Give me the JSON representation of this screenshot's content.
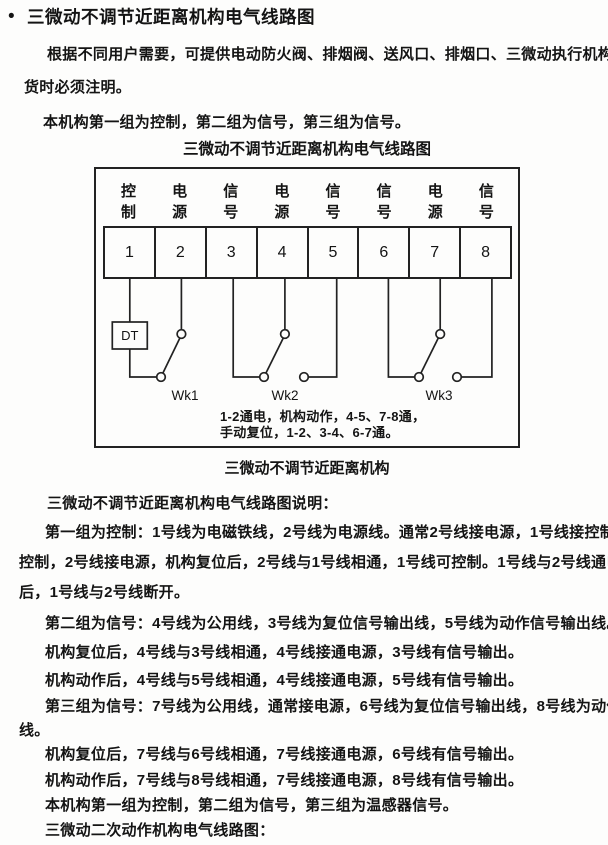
{
  "doc": {
    "header": {
      "bullet": "•",
      "title": "三微动不调节近距离机构电气线路图"
    },
    "intro_lines": [
      "根据不同用户需要，可提供电动防火阀、排烟阀、送风口、排烟口、三微动执行机构，用户订",
      "货时必须注明。",
      "本机构第一组为控制，第二组为信号，第三组为信号。"
    ],
    "figure": {
      "title": "三微动不调节近距离机构电气线路图",
      "caption": "三微动不调节近距离机构",
      "terminals": [
        {
          "label": "控制",
          "num": "1"
        },
        {
          "label": "电源",
          "num": "2"
        },
        {
          "label": "信号",
          "num": "3"
        },
        {
          "label": "电源",
          "num": "4"
        },
        {
          "label": "信号",
          "num": "5"
        },
        {
          "label": "信号",
          "num": "6"
        },
        {
          "label": "电源",
          "num": "7"
        },
        {
          "label": "信号",
          "num": "8"
        }
      ],
      "dt_label": "DT",
      "switch_labels": [
        "Wk1",
        "Wk2",
        "Wk3"
      ],
      "note_lines": [
        "1-2通电，机构动作，4-5、7-8通，",
        "手动复位，1-2、3-4、6-7通。"
      ]
    },
    "description_lines": [
      "三微动不调节近距离机构电气线路图说明：",
      "第一组为控制：1号线为电磁铁线，2号线为电源线。通常2号线接电源，1号线接控制。1号线接",
      "控制，2号线接电源，机构复位后，2号线与1号线相通，1号线可控制。1号线与2号线通电，机构动作",
      "后，1号线与2号线断开。",
      "第二组为信号：4号线为公用线，3号线为复位信号输出线，5号线为动作信号输出线。",
      "机构复位后，4号线与3号线相通，4号线接通电源，3号线有信号输出。",
      "机构动作后，4号线与5号线相通，4号线接通电源，5号线有信号输出。",
      "第三组为信号：7号线为公用线，通常接电源，6号线为复位信号输出线，8号线为动作信号输出",
      "线。",
      "机构复位后，7号线与6号线相通，7号线接通电源，6号线有信号输出。",
      "机构动作后，7号线与8号线相通，7号线接通电源，8号线有信号输出。",
      "本机构第一组为控制，第二组为信号，第三组为温感器信号。",
      "三微动二次动作机构电气线路图："
    ]
  }
}
